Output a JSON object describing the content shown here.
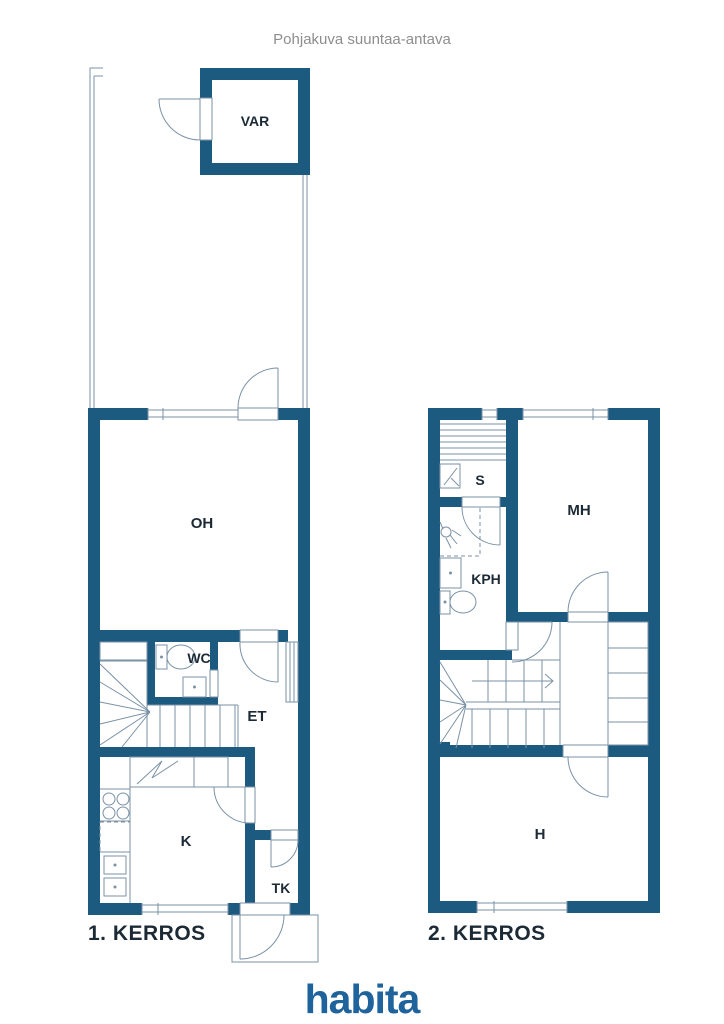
{
  "title": "Pohjakuva suuntaa-antava",
  "floor1": {
    "label": "1. KERROS",
    "rooms": {
      "var": "VAR",
      "oh": "OH",
      "wc": "WC",
      "et": "ET",
      "k": "K",
      "tk": "TK"
    }
  },
  "floor2": {
    "label": "2. KERROS",
    "rooms": {
      "s": "S",
      "mh": "MH",
      "kph": "KPH",
      "h": "H"
    }
  },
  "logo": {
    "text": "habita"
  },
  "icons": {
    "door": "door-swing-icon",
    "window": "window-icon",
    "stairs": "stairs-icon",
    "stair_direction": "arrow-right-icon",
    "toilet": "toilet-icon",
    "sink": "sink-icon",
    "shower": "shower-icon",
    "stove": "stove-icon",
    "sauna_benches": "sauna-bench-icon",
    "sauna_heater": "sauna-heater-icon",
    "radiator": "radiator-icon",
    "wardrobe": "wardrobe-icon",
    "fridge": "fridge-icon",
    "dishwasher": "dishwasher-icon"
  },
  "colors": {
    "wall": "#1d5a80",
    "line": "#7a92a6",
    "label": "#1c2a36",
    "title": "#8d8d8d",
    "logo": "#1f639c",
    "bg": "#ffffff"
  }
}
